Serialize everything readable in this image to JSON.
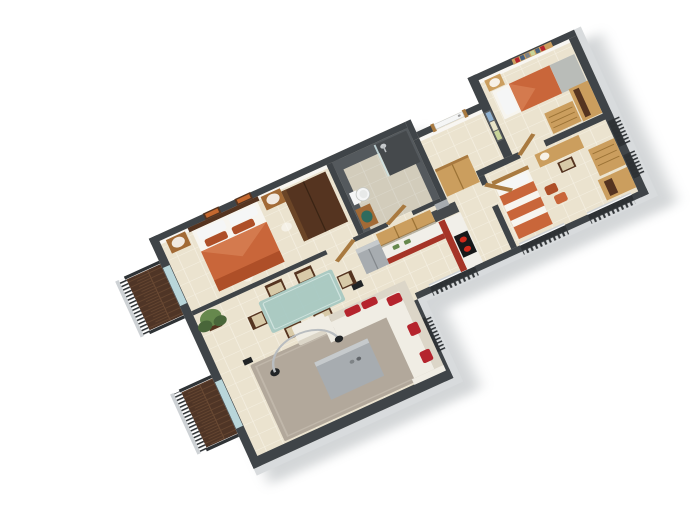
{
  "scene": {
    "label": "3D isometric floor plan render of a three-bedroom apartment, viewed from above at an angle on a white background",
    "type": "architectural 3d floor plan",
    "background": "#ffffff"
  },
  "palette": {
    "bg": "#ffffff",
    "wallcap": "#3f4448",
    "wallcapdark": "#2d3134",
    "wallouter": "#d8dbdd",
    "wallinner": "#f8f6f2",
    "floor": "#ebe3cf",
    "grout": "#f5f0e2",
    "bathwall": "#54595d",
    "bathdark": "#45494c",
    "bathshade": "#323638",
    "woodfloor": "#4f3526",
    "woodplank": "#6b4a33",
    "railing": "#2f3336",
    "railtop": "#ced2d5",
    "glass": "#b9d6da",
    "rug": "#b2a89b",
    "ruglight": "#c0b7aa",
    "sofa": "#f0ede4",
    "sofashadow": "#dcd6c8",
    "red": "#b5242d",
    "orange": "#c9663a",
    "orangedark": "#ae4f28",
    "linen": "#f7f5ef",
    "greyblanket": "#b9bcb8",
    "oak": "#cb9e5e",
    "oakdark": "#a97a40",
    "woodmid": "#a26a36",
    "wooddark": "#553420",
    "seatbeige": "#d8caa8",
    "counter": "#f1efe9",
    "kitchenred": "#a63427",
    "steel": "#a7acb0",
    "steellight": "#c6cacc",
    "cooktop": "#17191a",
    "burner": "#cf2a1c",
    "glasstable": "#a5c8c1",
    "plant": "#66884d",
    "plantdark": "#49663a",
    "white": "#f5f6f6",
    "teal": "#2e6b5e",
    "artorange": "#c4682f",
    "artblue": "#8fb0cf",
    "artcream": "#e8e4c8",
    "artolive": "#c8d49a",
    "lampglow": "#ffffff",
    "metal": "#b9bdc0"
  },
  "rooms": [
    {
      "id": "master-bedroom",
      "name": "Master bedroom",
      "furniture": [
        "double bed with orange duvet and white pillows",
        "two wooden nightstands with lamps",
        "two framed orange artworks",
        "dark wardrobe",
        "ceiling downlights"
      ]
    },
    {
      "id": "bathroom",
      "name": "Bathroom",
      "furniture": [
        "toilet",
        "walk-in shower with glass screen",
        "vanity with green basin",
        "wooden door"
      ]
    },
    {
      "id": "entry-hall",
      "name": "Entry hall",
      "furniture": [
        "white front door",
        "wooden closet",
        "blue-green wall art strip"
      ]
    },
    {
      "id": "bedroom-2",
      "name": "Bedroom 2",
      "furniture": [
        "single bed with orange duvet and grey foot blanket",
        "nightstand with lamp",
        "wall shelf with books",
        "oak dresser",
        "oak wardrobe",
        "wooden door"
      ]
    },
    {
      "id": "bedroom-3",
      "name": "Bedroom 3",
      "furniture": [
        "single bed with orange striped duvet",
        "desk with lamp",
        "wooden chair",
        "orange floor cushions",
        "oak dresser",
        "oak cabinet",
        "wooden door"
      ]
    },
    {
      "id": "kitchen",
      "name": "Open kitchen",
      "furniture": [
        "L-shaped counter with red base and white top",
        "upper oak cabinets",
        "stainless fridge",
        "black cooktop with red burners",
        "potted herbs",
        "dark backsplash column"
      ]
    },
    {
      "id": "living-dining",
      "name": "Living and dining room",
      "furniture": [
        "glass dining table",
        "six dark wood chairs",
        "white L-shaped sofa with red pillows",
        "taupe rug",
        "grey coffee table",
        "beige ottoman",
        "chrome arc floor lamp",
        "potted plant",
        "black speaker"
      ]
    },
    {
      "id": "balcony-1",
      "name": "Master balcony",
      "furniture": [
        "dark wood deck",
        "dark railing"
      ]
    },
    {
      "id": "balcony-2",
      "name": "Living room balcony",
      "furniture": [
        "dark wood deck",
        "dark railing"
      ]
    }
  ],
  "exterior": {
    "windows": "dark-railed window openings along the lower-right walls",
    "walls": "white walls with dark grey cut tops"
  }
}
